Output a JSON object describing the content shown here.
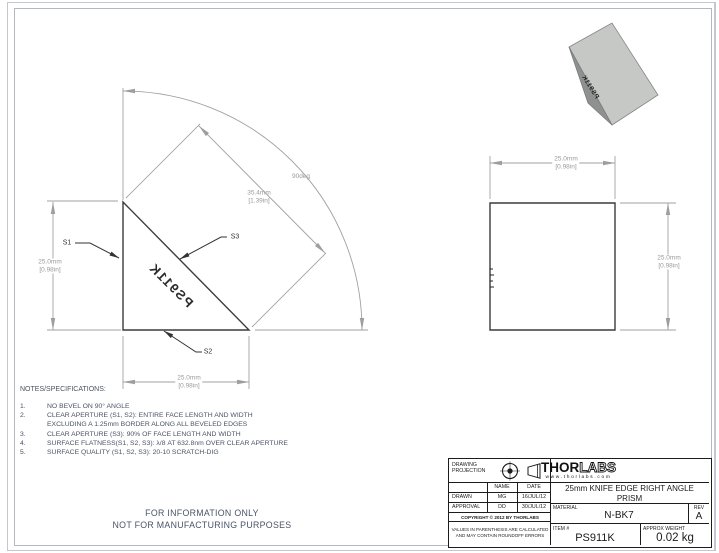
{
  "page": {
    "info_line1": "FOR INFORMATION ONLY",
    "info_line2": "NOT FOR MANUFACTURING PURPOSES"
  },
  "colors": {
    "object_line": "#3c3c3c",
    "dimension_line": "#a2a2a2",
    "dimension_text": "#9a9a9a",
    "note_ink": "#4a5364",
    "prism_light_face": "#c6c8c6",
    "prism_dark_face": "#8f9191",
    "title_block_ink": "#1c1c1c"
  },
  "views": {
    "side": {
      "engraving": "PS911K",
      "surface_labels": {
        "s1": "S1",
        "s2": "S2",
        "s3": "S3"
      },
      "dim_angle": "90deg",
      "dim_hyp_mm": "35.4mm",
      "dim_hyp_in": "[1.39in]",
      "dim_height_mm": "25.0mm",
      "dim_height_in": "[0.98in]",
      "dim_width_mm": "25.0mm",
      "dim_width_in": "[0.98in]"
    },
    "front": {
      "dim_width_mm": "25.0mm",
      "dim_width_in": "[0.98in]",
      "dim_height_mm": "25.0mm",
      "dim_height_in": "[0.98in]"
    },
    "iso": {
      "engraving": "PS911K"
    }
  },
  "notes": {
    "heading": "NOTES/SPECIFICATIONS:",
    "items": [
      {
        "num": "1.",
        "lines": [
          "NO BEVEL ON 90° ANGLE"
        ]
      },
      {
        "num": "2.",
        "lines": [
          "CLEAR APERTURE (S1, S2): ENTIRE FACE LENGTH AND WIDTH",
          "EXCLUDING A 1.25mm BORDER ALONG ALL BEVELED EDGES"
        ]
      },
      {
        "num": "3.",
        "lines": [
          "CLEAR APERTURE (S3): 90% OF FACE LENGTH AND WIDTH"
        ]
      },
      {
        "num": "4.",
        "lines": [
          "SURFACE FLATNESS(S1, S2, S3): λ/8 AT 632.8nm OVER CLEAR APERTURE"
        ]
      },
      {
        "num": "5.",
        "lines": [
          "SURFACE QUALITY (S1, S2, S3): 20-10 SCRATCH-DIG"
        ]
      }
    ]
  },
  "title_block": {
    "projection_label_1": "DRAWING",
    "projection_label_2": "PROJECTION",
    "table": {
      "name_header": "NAME",
      "date_header": "DATE",
      "drawn_label": "DRAWN",
      "drawn_name": "MG",
      "drawn_date": "16/JUL/12",
      "approval_label": "APPROVAL",
      "approval_name": "DD",
      "approval_date": "30/JUL/12"
    },
    "copyright": "COPYRIGHT © 2012 BY THORLABS",
    "disclaimer_1": "VALUES IN PARENTHESIS ARE CALCULATED",
    "disclaimer_2": "AND MAY CONTAIN ROUNDOFF ERRORS",
    "logo_thor": "THOR",
    "logo_labs": "LABS",
    "logo_url": "www.thorlabs.com",
    "title_line1": "25mm KNIFE EDGE RIGHT ANGLE",
    "title_line2": "PRISM",
    "material_label": "MATERIAL",
    "material_value": "N-BK7",
    "rev_label": "REV",
    "rev_value": "A",
    "item_label": "ITEM #",
    "item_value": "PS911K",
    "weight_label": "APPROX WEIGHT",
    "weight_value": "0.02 kg"
  }
}
